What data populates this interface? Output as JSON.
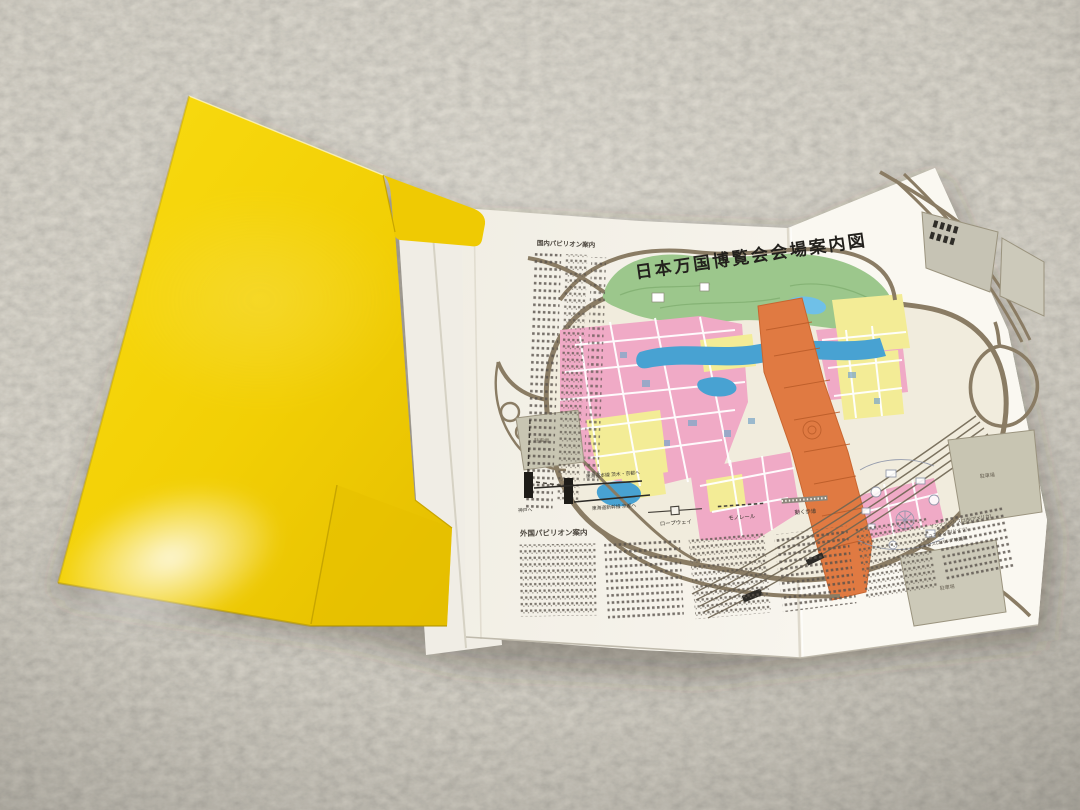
{
  "map": {
    "title": "日本万国博覧会会場案内図",
    "domestic_heading": "国内パビリオン案内",
    "foreign_heading": "外国パビリオン案内",
    "legend": {
      "ropeway": "ロープウェイ",
      "monorail": "モノレール",
      "moving_walkway": "動く歩道"
    },
    "railway": {
      "to_kobe": "神戸へ",
      "tokaido_main_line": "東海道本線 茨木・京都へ",
      "shinkansen": "東海道新幹線 京都へ"
    },
    "labels": {
      "parking": "駐車場"
    },
    "notes": [
      "チェコスロバキア映画館",
      "ミュンヘン市(ドイツ)",
      "サンフランシスコ市(アメリカ)"
    ]
  },
  "colors": {
    "carpet": "#a49e92",
    "folder_yellow": "#f2cf05",
    "paper_white": "#f5f2ea",
    "park_green": "#9cc78c",
    "water_blue": "#48a2d2",
    "block_pink": "#f0aac6",
    "block_yellow": "#f3ec96",
    "symbol_zone_orange": "#e07a42",
    "road_brown": "#8a7c64",
    "parking_gray": "#c8c5b2"
  }
}
